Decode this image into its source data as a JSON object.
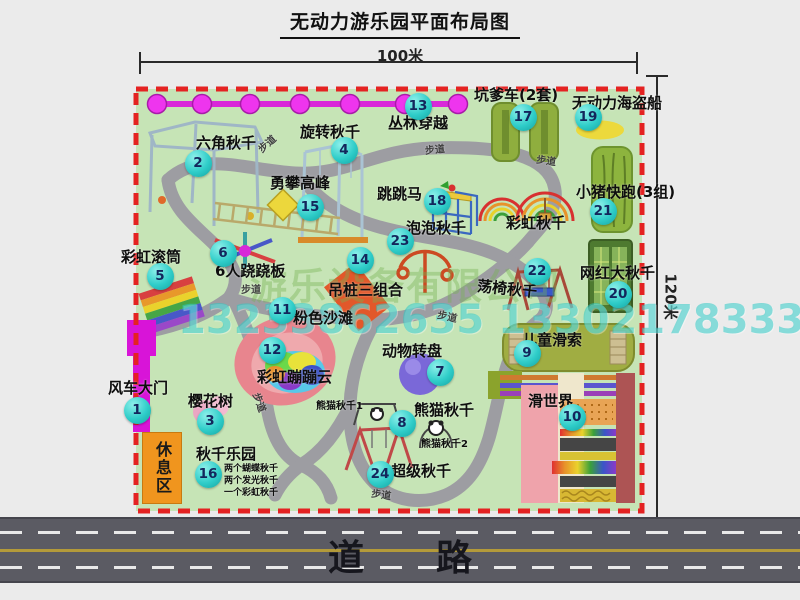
{
  "title": "无动力游乐园平面布局图",
  "dimensions": {
    "width": "100米",
    "height": "120米"
  },
  "road": {
    "label": "道　　路"
  },
  "rest_area": {
    "label": "休息区"
  },
  "watermarks": {
    "company": "游乐设备有限公司",
    "phone": "13233862635 13302178333"
  },
  "colors": {
    "background": "#ebebeb",
    "park_green": "#c6e4b6",
    "boundary_red": "#e42222",
    "path_gray": "#9d9da2",
    "marker_teal": "#2fcdc9",
    "fence_magenta": "#e02ce0",
    "gate_magenta": "#d814d8",
    "rest_area_orange": "#f0951e",
    "road_gray": "#5b5b63",
    "road_line_yellow": "#b39a3a"
  },
  "icons": [
    "jungle-crossing-chain",
    "windmill-gate",
    "hexagon-swing",
    "rotating-swing",
    "climbing-peak",
    "rainbow-drum",
    "seesaw-6p",
    "jumping-horse",
    "rainbow-swing-arcs",
    "bubble-swing",
    "hanging-piles",
    "swing-chair",
    "cherry-tree",
    "pink-beach",
    "rainbow-cloud",
    "animal-carousel",
    "panda-swing",
    "super-swing",
    "bumper-car-pads",
    "pirate-ship",
    "pig-run-pad",
    "big-swing-pad",
    "kids-zipline-pad",
    "slide-world",
    "rest-area-box"
  ],
  "markers": [
    {
      "n": "1",
      "x": 137,
      "y": 410
    },
    {
      "n": "2",
      "x": 198,
      "y": 163
    },
    {
      "n": "3",
      "x": 210,
      "y": 421
    },
    {
      "n": "4",
      "x": 344,
      "y": 150
    },
    {
      "n": "5",
      "x": 160,
      "y": 276
    },
    {
      "n": "6",
      "x": 223,
      "y": 253
    },
    {
      "n": "7",
      "x": 440,
      "y": 372
    },
    {
      "n": "8",
      "x": 402,
      "y": 423
    },
    {
      "n": "9",
      "x": 527,
      "y": 353
    },
    {
      "n": "10",
      "x": 572,
      "y": 417
    },
    {
      "n": "11",
      "x": 282,
      "y": 310
    },
    {
      "n": "12",
      "x": 272,
      "y": 350
    },
    {
      "n": "13",
      "x": 418,
      "y": 106
    },
    {
      "n": "14",
      "x": 360,
      "y": 260
    },
    {
      "n": "15",
      "x": 310,
      "y": 207
    },
    {
      "n": "16",
      "x": 208,
      "y": 474
    },
    {
      "n": "17",
      "x": 523,
      "y": 117
    },
    {
      "n": "18",
      "x": 437,
      "y": 201
    },
    {
      "n": "19",
      "x": 588,
      "y": 117
    },
    {
      "n": "20",
      "x": 618,
      "y": 294
    },
    {
      "n": "21",
      "x": 603,
      "y": 211
    },
    {
      "n": "22",
      "x": 537,
      "y": 271
    },
    {
      "n": "23",
      "x": 400,
      "y": 241
    },
    {
      "n": "24",
      "x": 380,
      "y": 474
    }
  ],
  "labels": [
    {
      "t": "六角秋千",
      "x": 196,
      "y": 136,
      "name": "label-hexagon-swing"
    },
    {
      "t": "旋转秋千",
      "x": 300,
      "y": 125,
      "name": "label-rotating-swing"
    },
    {
      "t": "丛林穿越",
      "x": 388,
      "y": 116,
      "name": "label-jungle-crossing"
    },
    {
      "t": "坑爹车(2套)",
      "x": 474,
      "y": 88,
      "name": "label-bumper-car"
    },
    {
      "t": "无动力海盗船",
      "x": 572,
      "y": 96,
      "name": "label-pirate-ship"
    },
    {
      "t": "勇攀高峰",
      "x": 270,
      "y": 176,
      "name": "label-climbing-peak"
    },
    {
      "t": "跳跳马",
      "x": 377,
      "y": 187,
      "name": "label-jumping-horse"
    },
    {
      "t": "小猪快跑(3组)",
      "x": 576,
      "y": 185,
      "name": "label-pig-run"
    },
    {
      "t": "彩虹秋千",
      "x": 506,
      "y": 216,
      "name": "label-rainbow-swing"
    },
    {
      "t": "泡泡秋千",
      "x": 406,
      "y": 221,
      "name": "label-bubble-swing"
    },
    {
      "t": "彩虹滚筒",
      "x": 121,
      "y": 250,
      "name": "label-rainbow-drum"
    },
    {
      "t": "6人跷跷板",
      "x": 215,
      "y": 264,
      "name": "label-seesaw"
    },
    {
      "t": "吊桩三组合",
      "x": 328,
      "y": 283,
      "name": "label-hanging-piles"
    },
    {
      "t": "荡椅秋千",
      "x": 477,
      "y": 282,
      "r": 6,
      "name": "label-swing-chair"
    },
    {
      "t": "网红大秋千",
      "x": 580,
      "y": 266,
      "name": "label-big-swing"
    },
    {
      "t": "粉色沙滩",
      "x": 293,
      "y": 311,
      "name": "label-pink-beach"
    },
    {
      "t": "彩虹蹦蹦云",
      "x": 257,
      "y": 370,
      "name": "label-rainbow-cloud"
    },
    {
      "t": "风车大门",
      "x": 108,
      "y": 381,
      "name": "label-windmill-gate"
    },
    {
      "t": "樱花树",
      "x": 188,
      "y": 394,
      "name": "label-cherry-tree"
    },
    {
      "t": "动物转盘",
      "x": 382,
      "y": 344,
      "name": "label-animal-carousel"
    },
    {
      "t": "熊猫秋千",
      "x": 414,
      "y": 403,
      "name": "label-panda-swing"
    },
    {
      "t": "熊猫秋千1",
      "x": 316,
      "y": 402,
      "s": 10,
      "name": "label-panda-swing-1"
    },
    {
      "t": "熊猫秋千2",
      "x": 421,
      "y": 440,
      "s": 10,
      "name": "label-panda-swing-2"
    },
    {
      "t": "超级秋千",
      "x": 391,
      "y": 464,
      "name": "label-super-swing"
    },
    {
      "t": "儿童滑索",
      "x": 522,
      "y": 333,
      "name": "label-kids-zipline"
    },
    {
      "t": "滑世界",
      "x": 528,
      "y": 394,
      "name": "label-slide-world"
    },
    {
      "t": "秋千乐园",
      "x": 196,
      "y": 447,
      "name": "label-swing-park"
    },
    {
      "t": "两个蝴蝶秋千",
      "x": 224,
      "y": 465,
      "s": 9,
      "name": "label-swing-note-1"
    },
    {
      "t": "两个发光秋千",
      "x": 224,
      "y": 477,
      "s": 9,
      "name": "label-swing-note-2"
    },
    {
      "t": "一个彩虹秋千",
      "x": 224,
      "y": 489,
      "s": 9,
      "name": "label-swing-note-3"
    },
    {
      "t": "步道",
      "x": 258,
      "y": 140,
      "s": 10,
      "r": -42,
      "c": "#3f3f3f",
      "name": "label-footpath"
    },
    {
      "t": "步道",
      "x": 425,
      "y": 146,
      "s": 10,
      "r": -6,
      "c": "#3f3f3f",
      "name": "label-footpath"
    },
    {
      "t": "步道",
      "x": 536,
      "y": 157,
      "s": 10,
      "r": 8,
      "c": "#3f3f3f",
      "name": "label-footpath"
    },
    {
      "t": "步道",
      "x": 241,
      "y": 286,
      "s": 10,
      "r": 0,
      "c": "#3f3f3f",
      "name": "label-footpath"
    },
    {
      "t": "步道",
      "x": 437,
      "y": 313,
      "s": 10,
      "r": 12,
      "c": "#3f3f3f",
      "name": "label-footpath"
    },
    {
      "t": "步道",
      "x": 248,
      "y": 398,
      "s": 10,
      "r": 70,
      "c": "#3f3f3f",
      "name": "label-footpath"
    },
    {
      "t": "步道",
      "x": 371,
      "y": 491,
      "s": 10,
      "r": 8,
      "c": "#3f3f3f",
      "name": "label-footpath"
    }
  ]
}
